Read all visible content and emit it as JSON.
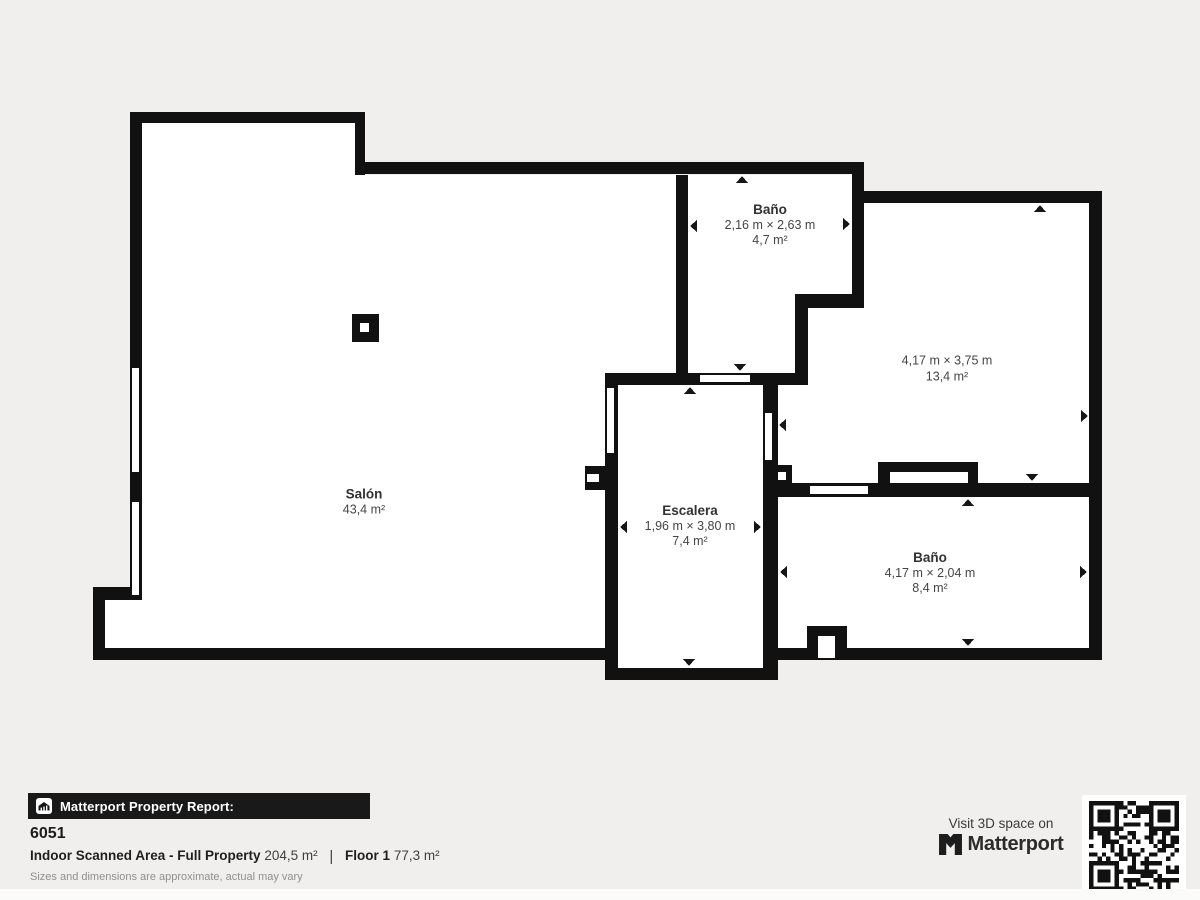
{
  "colors": {
    "background": "#f0efee",
    "wall": "#111111",
    "floor": "#ffffff",
    "label_text": "#454545",
    "footer_bar": "#191919"
  },
  "plan": {
    "rooms": [
      {
        "name": "Salón",
        "dims": "",
        "area": "43,4 m²"
      },
      {
        "name": "Baño",
        "dims": "2,16 m × 2,63 m",
        "area": "4,7 m²"
      },
      {
        "name": "",
        "dims": "4,17 m × 3,75 m",
        "area": "13,4 m²"
      },
      {
        "name": "Escalera",
        "dims": "1,96 m × 3,80 m",
        "area": "7,4 m²"
      },
      {
        "name": "Baño",
        "dims": "4,17 m × 2,04 m",
        "area": "8,4 m²"
      }
    ]
  },
  "footer": {
    "report_label": "Matterport Property Report:",
    "property_id": "6051",
    "area_label": "Indoor Scanned Area - Full Property",
    "area_value": "204,5 m²",
    "divider": "|",
    "floor_label": "Floor 1",
    "floor_value": "77,3 m²",
    "disclaimer": "Sizes and dimensions are approximate, actual may vary",
    "visit_label": "Visit 3D space on",
    "brand_name": "Matterport"
  }
}
